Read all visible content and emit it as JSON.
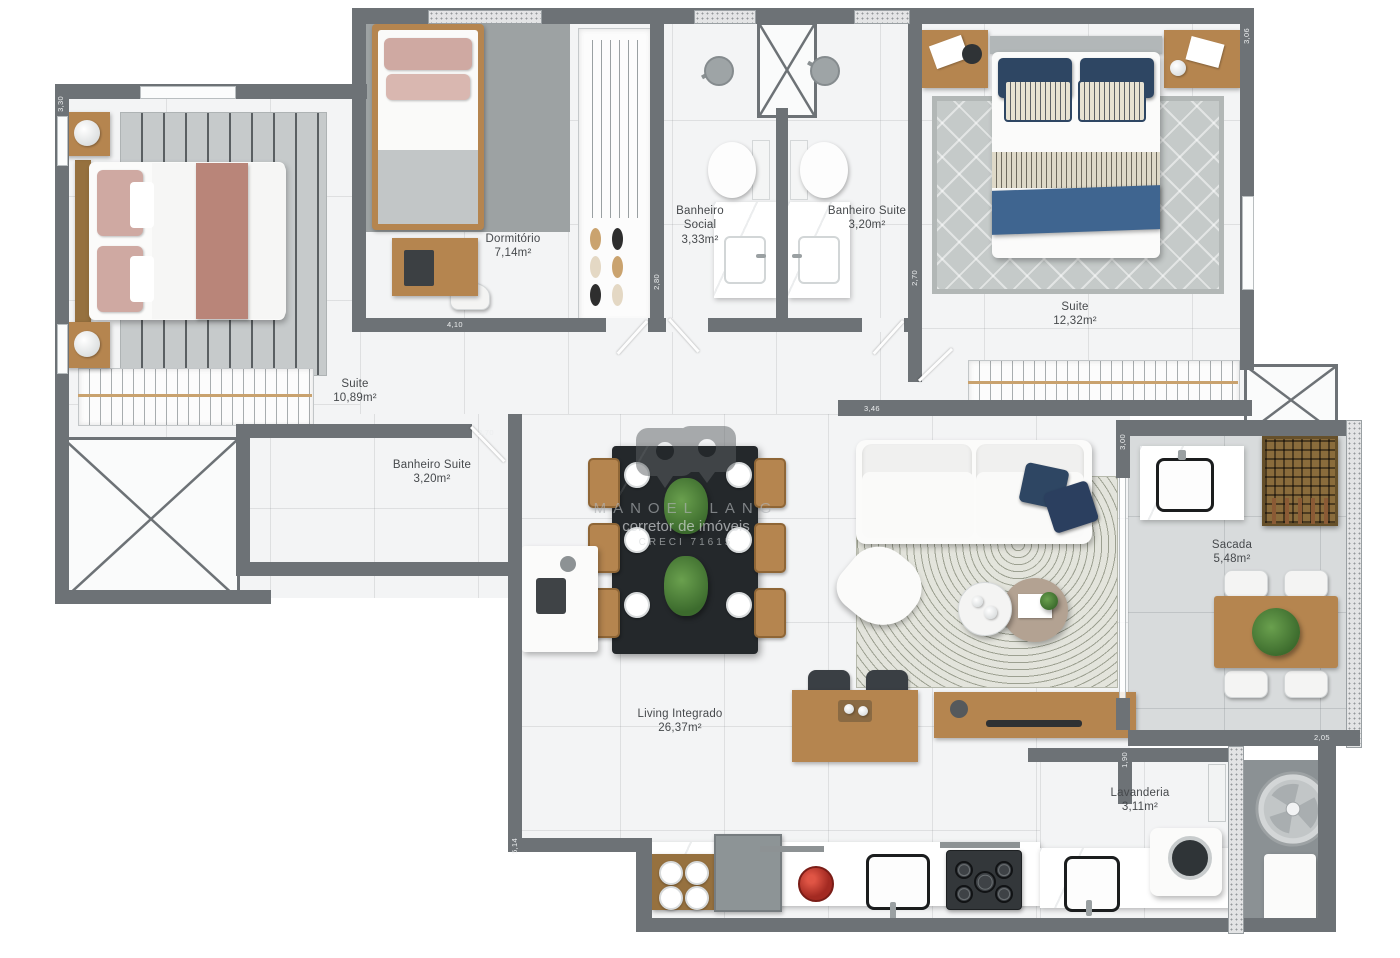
{
  "rooms": [
    {
      "name": "Dormitório",
      "area": "7,14m²"
    },
    {
      "name": "Banheiro Social",
      "area": "3,33m²"
    },
    {
      "name": "Banheiro Suite",
      "area": "3,20m²"
    },
    {
      "name": "Suite",
      "area": "12,32m²"
    },
    {
      "name": "Suite",
      "area": "10,89m²"
    },
    {
      "name": "Banheiro Suite",
      "area": "3,20m²"
    },
    {
      "name": "Living Integrado",
      "area": "26,37m²"
    },
    {
      "name": "Sacada",
      "area": "5,48m²"
    },
    {
      "name": "Lavanderia",
      "area": "3,11m²"
    }
  ],
  "dims": {
    "d330": "3,30",
    "d410": "4,10",
    "d270a": "2,70",
    "d280": "2,80",
    "d270b": "2,70",
    "d346": "3,46",
    "d300": "3,00",
    "d306": "3,06",
    "d190": "1,90",
    "d514": "5,14",
    "d205": "2,05"
  },
  "watermark": {
    "name": "MANOEL LANG",
    "role": "corretor de imóveis",
    "creci": "CRECI 71615"
  },
  "colors": {
    "wall": "#6d7276",
    "floor": "#f3f4f5",
    "balcony_floor": "#d8dbdc",
    "wood": "#b5854f",
    "navy_pillow": "#2e4663",
    "blue_throw": "#3f6590",
    "rose_bed": "#b98579",
    "plant": "#4c7d3a",
    "dark_table": "#24282b",
    "appliance": "#8d9496"
  }
}
